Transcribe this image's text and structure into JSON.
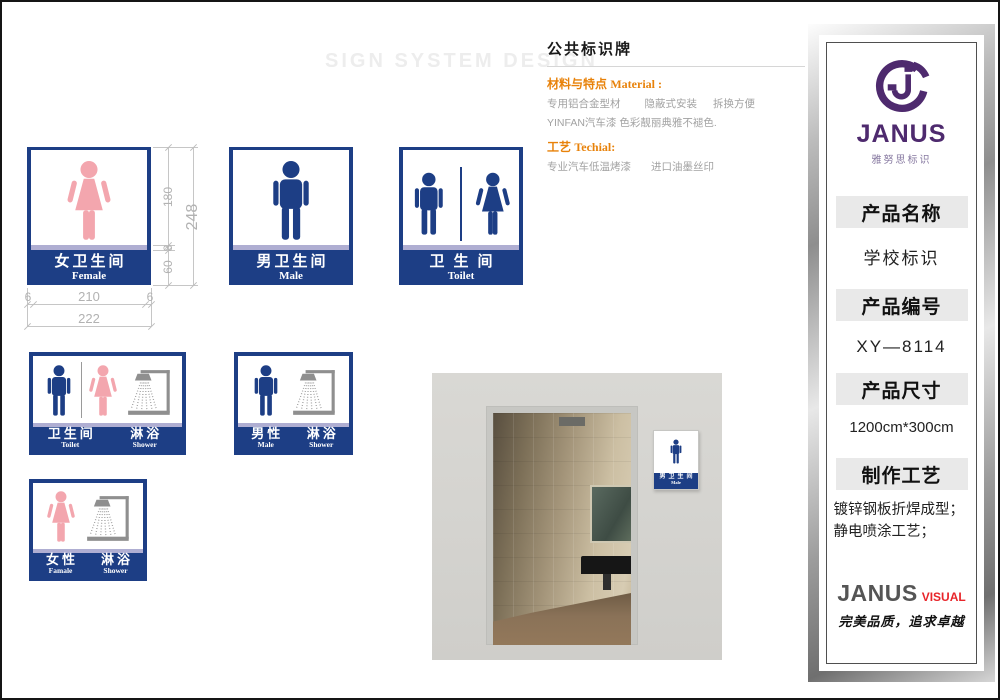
{
  "page": {
    "watermark": "SIGN SYSTEM DESIGN"
  },
  "header": {
    "title": "公共标识牌",
    "material_label": "材料与特点",
    "material_label_en": "Material :",
    "material_items": [
      "专用铝合金型材",
      "隐蔽式安装",
      "拆换方便"
    ],
    "material_line2": "YINFAN汽车漆   色彩靓丽典雅不褪色.",
    "tech_label": "工艺",
    "tech_label_en": "Techial:",
    "tech_items": [
      "专业汽车低温烤漆",
      "进口油墨丝印"
    ]
  },
  "signs": {
    "female": {
      "cn": "女卫生间",
      "en": "Female"
    },
    "male": {
      "cn": "男卫生间",
      "en": "Male"
    },
    "unisex": {
      "cn": "卫生间",
      "en": "Toilet"
    },
    "combo_unisex_shower": {
      "left_cn": "卫生间",
      "left_en": "Toilet",
      "right_cn": "淋浴",
      "right_en": "Shower"
    },
    "combo_male_shower": {
      "left_cn": "男性",
      "left_en": "Male",
      "right_cn": "淋浴",
      "right_en": "Shower"
    },
    "combo_female_shower": {
      "left_cn": "女性",
      "left_en": "Famale",
      "right_cn": "淋浴",
      "right_en": "Shower"
    },
    "photo_sign": {
      "cn": "男卫生间",
      "en": "Male"
    }
  },
  "dimensions": {
    "seg_top": "180",
    "seg_stripe": "8",
    "seg_band": "60",
    "total_height": "248",
    "margin_left": "6",
    "inner_width": "210",
    "margin_right": "6",
    "total_width": "222"
  },
  "panel": {
    "brand": "JANUS",
    "brand_sub": "雅努思标识",
    "product_name_label": "产品名称",
    "product_name": "学校标识",
    "product_code_label": "产品编号",
    "product_code": "XY—8114",
    "product_size_label": "产品尺寸",
    "product_size": "1200cm*300cm",
    "craft_label": "制作工艺",
    "craft_text": "镀锌钢板折焊成型；静电喷涂工艺；",
    "footer_brand": "JANUS",
    "footer_brand_suffix": "VISUAL",
    "footer_slogan": "完美品质，追求卓越"
  },
  "colors": {
    "navy": "#1d3e85",
    "lavender": "#afaed2",
    "pink": "#f3a6ae",
    "orange": "#e8820a",
    "purple": "#4e2a6e",
    "brand-red": "#e8252a"
  }
}
